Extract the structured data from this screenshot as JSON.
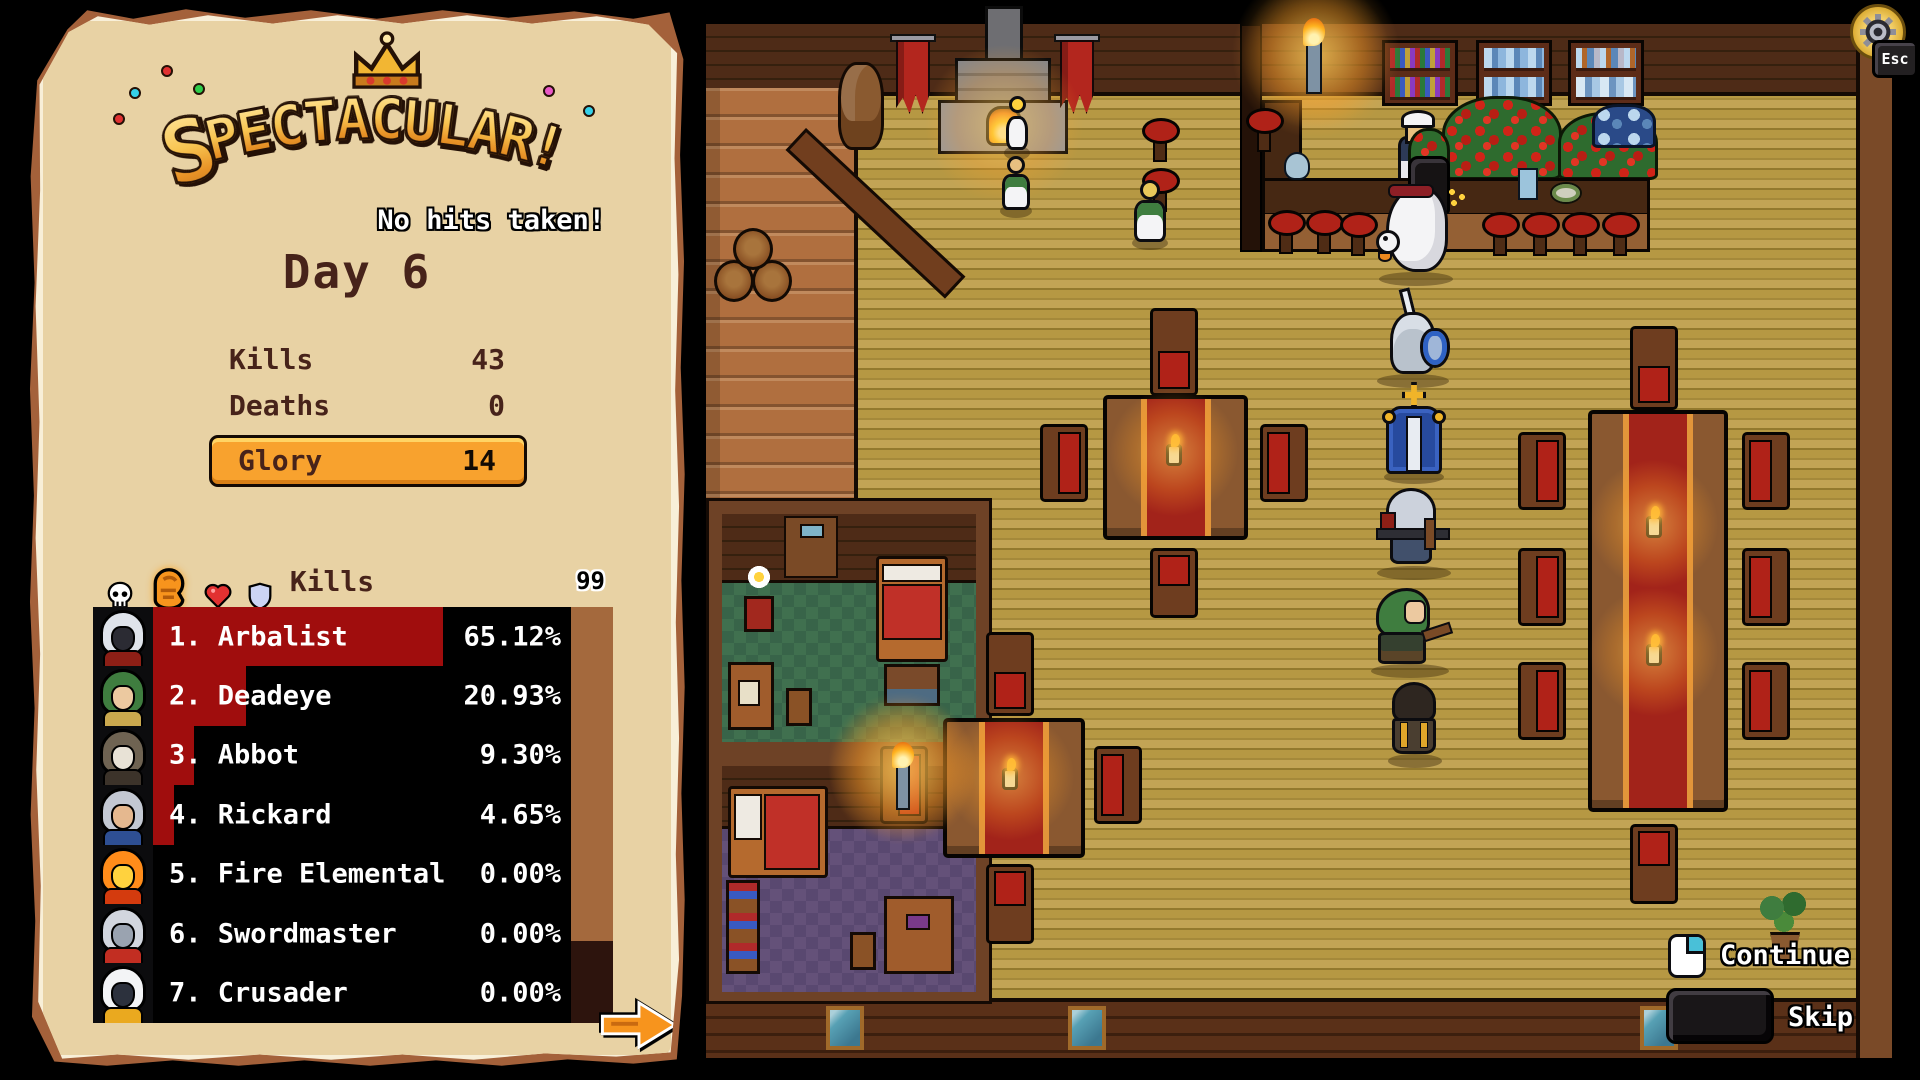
{
  "panel": {
    "title": "Spectacular!",
    "subtitle": "No hits taken!",
    "day": "Day 6",
    "stats": [
      {
        "label": "Kills",
        "value": "43"
      },
      {
        "label": "Deaths",
        "value": "0"
      }
    ],
    "glory": {
      "label": "Glory",
      "value": "14"
    },
    "tabs": [
      {
        "name": "deaths",
        "icon": "skull-icon",
        "selected": false
      },
      {
        "name": "kills",
        "icon": "fist-icon",
        "selected": true
      },
      {
        "name": "health",
        "icon": "heart-icon",
        "selected": false
      },
      {
        "name": "blocks",
        "icon": "shield-icon",
        "selected": false
      }
    ],
    "board": {
      "header": "Kills",
      "counter": "99",
      "rows": [
        {
          "rank": "1.",
          "name": "Arbalist",
          "pct": "65.12%",
          "value": 65.12,
          "portrait": {
            "hood": "#dfe3ea",
            "face": "#2b2b33",
            "acc": "#8d1f16"
          }
        },
        {
          "rank": "2.",
          "name": "Deadeye",
          "pct": "20.93%",
          "value": 20.93,
          "portrait": {
            "hood": "#3f7d3f",
            "face": "#ecc9a0",
            "acc": "#caa84e"
          }
        },
        {
          "rank": "3.",
          "name": "Abbot",
          "pct": "9.30%",
          "value": 9.3,
          "portrait": {
            "hood": "#6f6352",
            "face": "#e8e2d6",
            "acc": "#3c332a"
          }
        },
        {
          "rank": "4.",
          "name": "Rickard",
          "pct": "4.65%",
          "value": 4.65,
          "portrait": {
            "hood": "#c3c8d2",
            "face": "#e5b88f",
            "acc": "#2e4f93"
          }
        },
        {
          "rank": "5.",
          "name": "Fire Elemental",
          "pct": "0.00%",
          "value": 0,
          "portrait": {
            "hood": "#ff8c1a",
            "face": "#ffd23e",
            "acc": "#d43b0e"
          }
        },
        {
          "rank": "6.",
          "name": "Swordmaster",
          "pct": "0.00%",
          "value": 0,
          "portrait": {
            "hood": "#d2d6de",
            "face": "#9aa3b0",
            "acc": "#c22e22"
          }
        },
        {
          "rank": "7.",
          "name": "Crusader",
          "pct": "0.00%",
          "value": 0,
          "portrait": {
            "hood": "#f3f4f6",
            "face": "#2c313d",
            "acc": "#eaa91f"
          }
        }
      ]
    }
  },
  "hud": {
    "continue_label": "Continue",
    "skip_label": "Skip",
    "esc_label": "Esc"
  },
  "scene": {
    "fixtures": [
      "fireplace",
      "wall-banners",
      "mounted-trophy",
      "staircase",
      "barrels",
      "bottle-shelves",
      "rose-piles",
      "bar-counter",
      "bar-stools",
      "torches",
      "square-tables",
      "long-table",
      "chairs",
      "candles",
      "bedroom-green",
      "bedroom-purple",
      "windows",
      "potted-plant"
    ],
    "npcs": [
      "bartender-nun",
      "goose",
      "chick",
      "barmaid",
      "tavern-maid",
      "swordmaster",
      "crusader",
      "arbalist",
      "deadeye",
      "abbot"
    ]
  },
  "palette": {
    "parchment": "#e8d2a4",
    "parchEdge": "#f8efd8",
    "parchTrim": "#a4613a",
    "ink": "#47231a",
    "glory": "#f8a22e",
    "gloryHi": "#ffd465",
    "gloryLo": "#d87f16",
    "barRed": "#a00d0d",
    "listBg": "#000000",
    "scrollThumb": "#a4693d",
    "scrollTrack": "#2d140d",
    "floorA": "#b69843",
    "floorB": "#a5893a",
    "floorC": "#c2a455",
    "wall": "#4e2b17",
    "wallLine": "#35200e",
    "stair": "#b06f3f",
    "counterTop": "#462813",
    "counterFace": "#946034",
    "wood": "#8a5830",
    "runner": "#a2231a",
    "runnerTrim": "#e2953a",
    "chairRed": "#b02218",
    "chairBack": "#6e3d1f",
    "roomGreenA": "#40704f",
    "roomGreenB": "#386449",
    "roomPurpleA": "#645179",
    "roomPurpleB": "#594870",
    "frame": "#6e4226",
    "bannerRed": "#b3261e",
    "gold": "#f2b633"
  }
}
